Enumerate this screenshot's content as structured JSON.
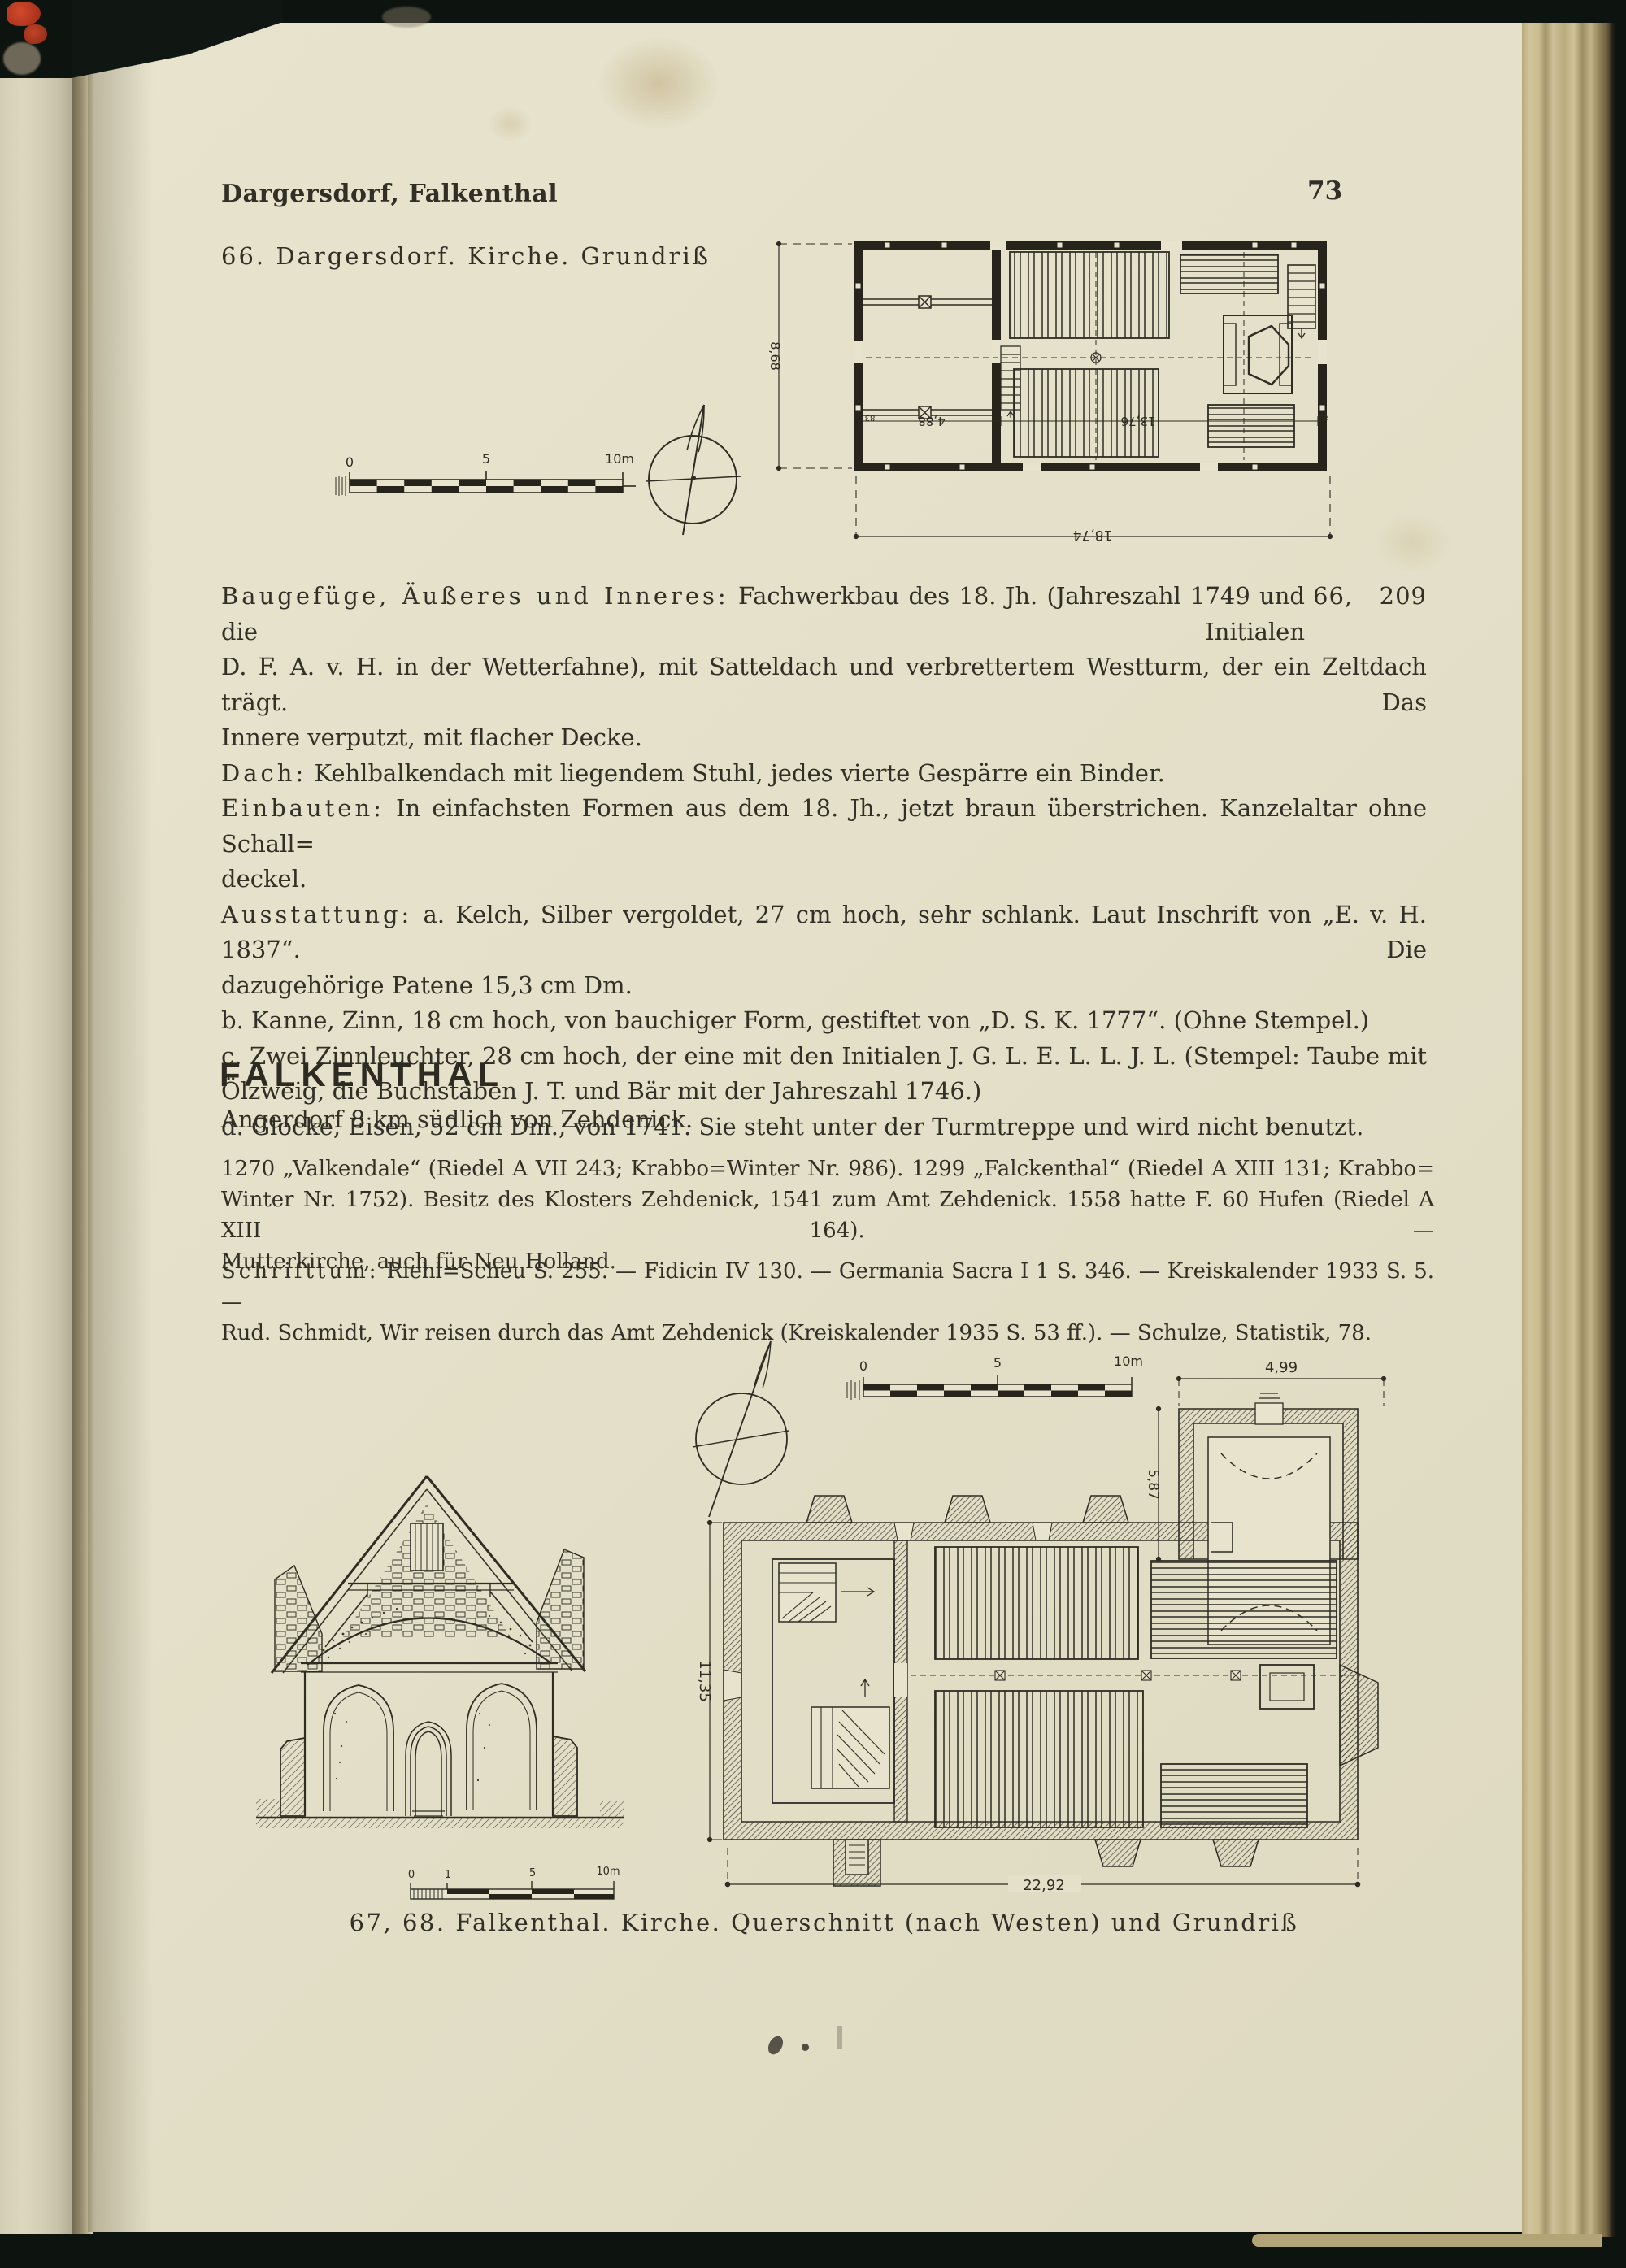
{
  "header": {
    "title": "Dargersdorf, Falkenthal",
    "page_number": "73"
  },
  "figure66": {
    "caption": "66. Dargersdorf. Kirche. Grundriß",
    "scale": {
      "zero": "0",
      "five": "5",
      "ten": "10m"
    },
    "dims": {
      "height": "8,68",
      "width": "18,74",
      "tower": "4,88",
      "nave": "13,76",
      "wall_left": "83",
      "wall_right": "83"
    }
  },
  "description": {
    "margin_ref": "66, 209",
    "lines": [
      {
        "lead": "Baugefüge, Äußeres und Inneres:",
        "rest": " Fachwerkbau des 18. Jh. (Jahreszahl 1749 und die Initialen"
      },
      {
        "rest": "D. F. A. v. H. in der Wetterfahne), mit Satteldach und verbrettertem Westturm, der ein Zeltdach trägt. Das"
      },
      {
        "rest": "Innere verputzt, mit flacher Decke."
      },
      {
        "lead": "Dach:",
        "rest": " Kehlbalkendach mit liegendem Stuhl, jedes vierte Gespärre ein Binder."
      },
      {
        "lead": "Einbauten:",
        "rest": " In einfachsten Formen aus dem 18. Jh., jetzt braun überstrichen. Kanzelaltar ohne Schall="
      },
      {
        "rest": "deckel."
      },
      {
        "lead": "Ausstattung:",
        "rest": " a. Kelch, Silber vergoldet, 27 cm hoch, sehr schlank. Laut Inschrift von „E. v. H. 1837“. Die"
      },
      {
        "rest": "dazugehörige Patene 15,3 cm Dm."
      },
      {
        "rest": "b. Kanne, Zinn, 18 cm hoch, von bauchiger Form, gestiftet von „D. S. K. 1777“. (Ohne Stempel.)"
      },
      {
        "rest": "c. Zwei Zinnleuchter, 28 cm hoch, der eine mit den Initialen J. G. L. E. L. L. J. L.  (Stempel: Taube mit"
      },
      {
        "rest": "Ölzweig, die Buchstaben J. T. und Bär mit der Jahreszahl 1746.)"
      },
      {
        "rest": "d. Glocke, Eisen, 52 cm Dm., von 1741. Sie steht unter der Turmtreppe und wird nicht benutzt."
      }
    ]
  },
  "falkenthal": {
    "heading": "FALKENTHAL",
    "subtitle": "Angerdorf 8 km südlich von Zehdenick.",
    "history": [
      "1270 „Valkendale“ (Riedel A VII 243; Krabbo=Winter Nr. 986). 1299 „Falckenthal“ (Riedel A XIII 131; Krabbo=",
      "Winter Nr. 1752). Besitz des Klosters Zehdenick, 1541 zum Amt Zehdenick. 1558 hatte F. 60 Hufen (Riedel A XIII 164). —",
      "Mutterkirche, auch für Neu Holland."
    ],
    "schrifttum": {
      "lead": "Schrifttum:",
      "line1": " Riehl=Scheu S. 255. — Fidicin IV 130. — Germania Sacra I 1 S. 346. — Kreiskalender 1933 S. 5. —",
      "line2": "Rud. Schmidt, Wir reisen durch das Amt Zehdenick (Kreiskalender 1935 S. 53 ff.). — Schulze, Statistik, 78."
    }
  },
  "figure6768": {
    "caption": "67, 68. Falkenthal. Kirche. Querschnitt (nach Westen) und Grundriß",
    "plan_scale": {
      "zero": "0",
      "five": "5",
      "ten": "10m"
    },
    "section_scale": {
      "zero": "0",
      "one": "1",
      "five": "5",
      "ten": "10m"
    },
    "dims": {
      "tower_width": "4,99",
      "tower_depth": "5,87",
      "nave_depth": "11,35",
      "nave_length": "22,92"
    }
  }
}
